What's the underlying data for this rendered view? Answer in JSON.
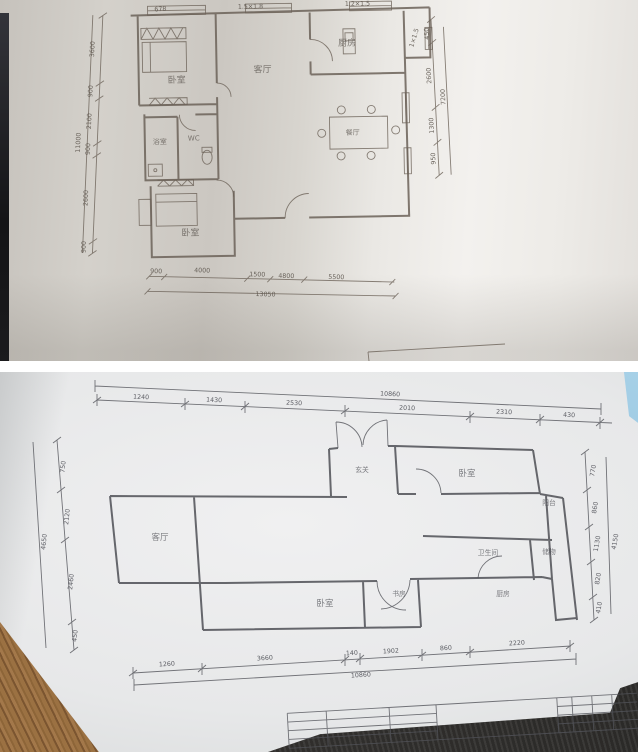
{
  "top_plan": {
    "rooms": {
      "bedroom1": "卧室",
      "kitchen": "厨房",
      "living": "客厅",
      "dining": "餐厅",
      "bath": "浴室",
      "wc": "WC",
      "bedroom2": "卧室"
    },
    "window_labels": {
      "w1": "678",
      "w2": "1.5×1.8",
      "w3": "1.2×1.5",
      "w4": "1×1.5"
    },
    "dims": {
      "left": {
        "segments": [
          "3600",
          "900",
          "2100",
          "900",
          "2600",
          "900"
        ],
        "total": "11000"
      },
      "right": {
        "segments": [
          "450",
          "2600",
          "1300",
          "950"
        ],
        "total": "7200"
      },
      "bottom": {
        "segments": [
          "900",
          "4000",
          "1500",
          "4800",
          "5500"
        ],
        "total": "13050"
      }
    }
  },
  "bottom_plan": {
    "rooms": {
      "living": "客厅",
      "entry": "玄关",
      "bedroom_right": "卧室",
      "balcony": "阳台",
      "bathroom": "卫生间",
      "storage": "储物",
      "bedroom_lower": "卧室",
      "study": "书房",
      "kitchen": "厨房"
    },
    "dims": {
      "top": {
        "segments": [
          "1240",
          "1430",
          "2530",
          "2010",
          "2310",
          "430"
        ],
        "total": "10860"
      },
      "bottom": {
        "segments": [
          "1260",
          "3660",
          "140",
          "1902",
          "860",
          "2220"
        ],
        "total": "10860"
      },
      "left": {
        "segments": [
          "750",
          "2120",
          "2460",
          "450"
        ],
        "total": "4650"
      },
      "right": {
        "segments": [
          "770",
          "860",
          "1130",
          "820",
          "410"
        ],
        "total": "4150"
      }
    }
  }
}
